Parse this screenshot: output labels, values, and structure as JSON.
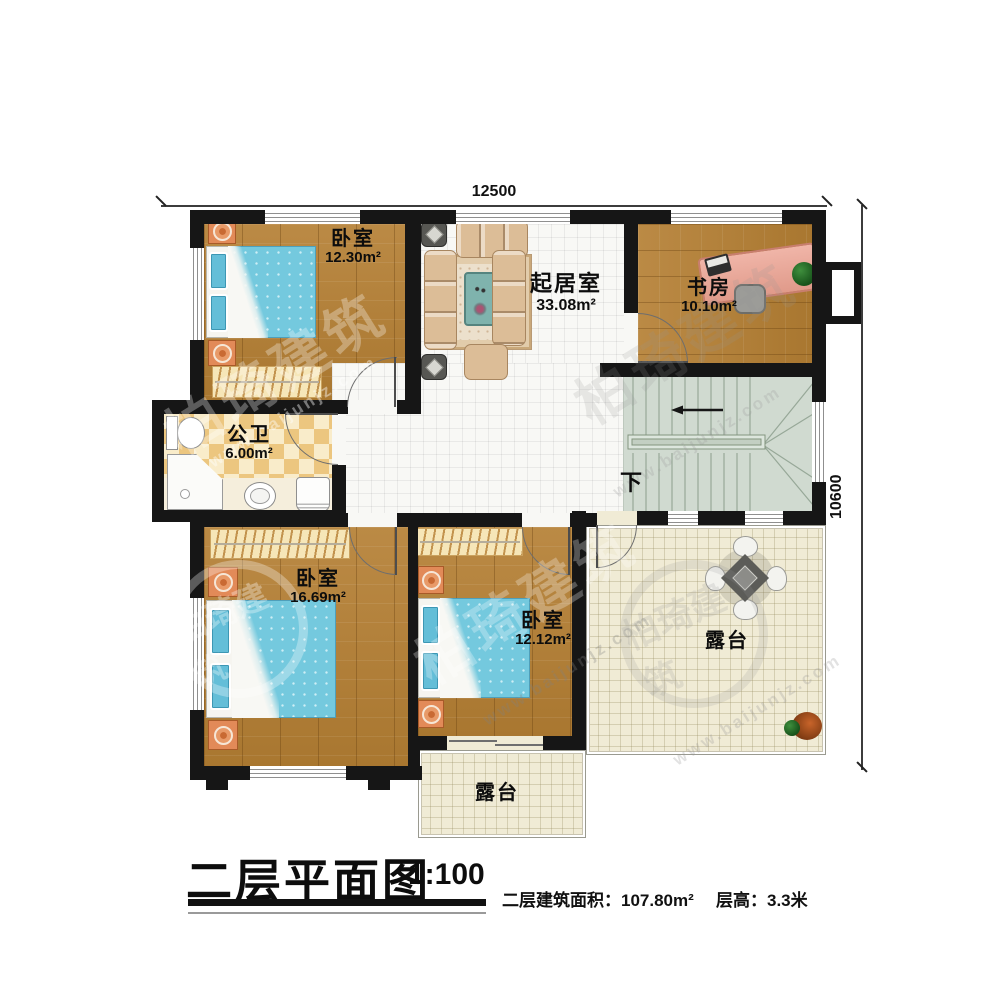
{
  "dimensions": {
    "width": "12500",
    "height": "10600"
  },
  "rooms": {
    "bedroom_top_left": {
      "name": "卧室",
      "area": "12.30m²"
    },
    "living_room": {
      "name": "起居室",
      "area": "33.08m²"
    },
    "study": {
      "name": "书房",
      "area": "10.10m²"
    },
    "bathroom": {
      "name": "公卫",
      "area": "6.00m²"
    },
    "bedroom_bottom_left": {
      "name": "卧室",
      "area": "16.69m²"
    },
    "bedroom_bottom_mid": {
      "name": "卧室",
      "area": "12.12m²"
    },
    "terrace_right": {
      "name": "露台"
    },
    "terrace_bottom": {
      "name": "露台"
    }
  },
  "stairs": {
    "down_label": "下"
  },
  "footer": {
    "title": "二层平面图",
    "scale": "1:100",
    "area_label": "二层建筑面积：",
    "area_value": "107.80m²",
    "height_label": "层高：",
    "height_value": "3.3米"
  },
  "watermark": {
    "brand": "柏琦建筑",
    "url": "www.baijunjz.com"
  },
  "colors": {
    "wall": "#161616",
    "wood": "#b3813d",
    "tile": "#f8f8f5",
    "bath_checker": "#ecc67f",
    "stairs": "#d0dad0",
    "terrace": "#f0ebd5",
    "bed": "#74c9de",
    "desk": "#e8a89a"
  }
}
